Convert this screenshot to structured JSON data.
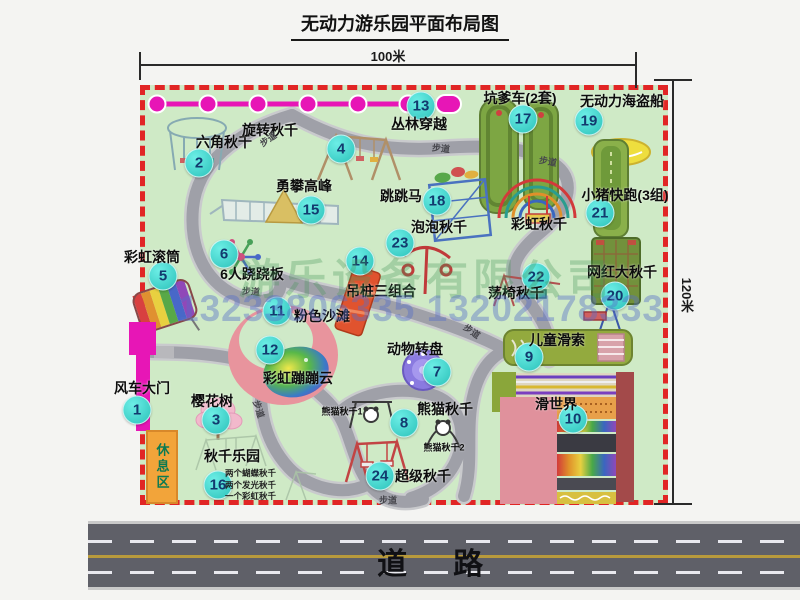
{
  "title": "无动力游乐园平面布局图",
  "dimensions": {
    "top": "100米",
    "right": "120米"
  },
  "road": {
    "label": "道路"
  },
  "rest_area": {
    "label": "休息区"
  },
  "watermark": {
    "line1": "游乐设备有限公司",
    "line2": "13233806335 13202178333"
  },
  "colors": {
    "map_bg": "#cfeac6",
    "border_red": "#e12525",
    "walkway": "#9fa0a8",
    "marker": "#2cc2ba",
    "marker_text": "#123a6e",
    "magenta_track": "#e716b6",
    "road_gray": "#5f6068",
    "rest_orange": "#f2a43a"
  },
  "attractions": [
    {
      "num": "1",
      "name": "风车大门",
      "cx": 137,
      "cy": 410,
      "lx": 142,
      "ly": 388
    },
    {
      "num": "2",
      "name": "六角秋千",
      "cx": 199,
      "cy": 163,
      "lx": 224,
      "ly": 142
    },
    {
      "num": "3",
      "name": "樱花树",
      "cx": 216,
      "cy": 420,
      "lx": 212,
      "ly": 401
    },
    {
      "num": "4",
      "name": "旋转秋千",
      "cx": 341,
      "cy": 149,
      "lx": 270,
      "ly": 130
    },
    {
      "num": "5",
      "name": "彩虹滚筒",
      "cx": 163,
      "cy": 276,
      "lx": 152,
      "ly": 257
    },
    {
      "num": "6",
      "name": "6人跷跷板",
      "cx": 224,
      "cy": 254,
      "lx": 252,
      "ly": 274
    },
    {
      "num": "7",
      "name": "动物转盘",
      "cx": 437,
      "cy": 372,
      "lx": 415,
      "ly": 349
    },
    {
      "num": "8",
      "name": "熊猫秋千",
      "cx": 404,
      "cy": 423,
      "lx": 445,
      "ly": 409
    },
    {
      "num": "9",
      "name": "儿童滑索",
      "cx": 529,
      "cy": 357,
      "lx": 557,
      "ly": 340
    },
    {
      "num": "10",
      "name": "滑世界",
      "cx": 573,
      "cy": 419,
      "lx": 556,
      "ly": 404
    },
    {
      "num": "11",
      "name": "粉色沙滩",
      "cx": 277,
      "cy": 311,
      "lx": 322,
      "ly": 316
    },
    {
      "num": "12",
      "name": "彩虹蹦蹦云",
      "cx": 270,
      "cy": 350,
      "lx": 298,
      "ly": 378
    },
    {
      "num": "13",
      "name": "丛林穿越",
      "cx": 421,
      "cy": 106,
      "lx": 419,
      "ly": 124
    },
    {
      "num": "14",
      "name": "吊桩三组合",
      "cx": 360,
      "cy": 261,
      "lx": 381,
      "ly": 291
    },
    {
      "num": "15",
      "name": "勇攀高峰",
      "cx": 311,
      "cy": 210,
      "lx": 304,
      "ly": 186
    },
    {
      "num": "16",
      "name": "秋千乐园",
      "cx": 218,
      "cy": 485,
      "lx": 232,
      "ly": 456
    },
    {
      "num": "17",
      "name": "坑爹车(2套)",
      "cx": 523,
      "cy": 119,
      "lx": 520,
      "ly": 98
    },
    {
      "num": "18",
      "name": "跳跳马",
      "cx": 437,
      "cy": 201,
      "lx": 401,
      "ly": 196
    },
    {
      "num": "19",
      "name": "无动力海盗船",
      "cx": 589,
      "cy": 121,
      "lx": 622,
      "ly": 101
    },
    {
      "num": "20",
      "name": "网红大秋千",
      "cx": 615,
      "cy": 296,
      "lx": 622,
      "ly": 272
    },
    {
      "num": "21",
      "name": "小猪快跑(3组)",
      "cx": 600,
      "cy": 213,
      "lx": 625,
      "ly": 195
    },
    {
      "num": "22",
      "name": "荡椅秋千",
      "cx": 536,
      "cy": 277,
      "lx": 516,
      "ly": 293
    },
    {
      "num": "23",
      "name": "泡泡秋千",
      "cx": 400,
      "cy": 243,
      "lx": 439,
      "ly": 227
    },
    {
      "num": "24",
      "name": "超级秋千",
      "cx": 380,
      "cy": 476,
      "lx": 423,
      "ly": 476
    }
  ],
  "extra_labels": [
    {
      "text": "彩虹秋千",
      "x": 539,
      "y": 224,
      "size": 14
    },
    {
      "text": "熊猫秋千1",
      "x": 342,
      "y": 411,
      "size": 9
    },
    {
      "text": "熊猫秋千2",
      "x": 444,
      "y": 447,
      "size": 9
    }
  ],
  "walkway_labels": [
    {
      "text": "步道",
      "x": 268,
      "y": 139,
      "rot": -35
    },
    {
      "text": "步道",
      "x": 441,
      "y": 148,
      "rot": 6
    },
    {
      "text": "步道",
      "x": 548,
      "y": 161,
      "rot": 10
    },
    {
      "text": "步道",
      "x": 251,
      "y": 291,
      "rot": 4
    },
    {
      "text": "步道",
      "x": 472,
      "y": 331,
      "rot": 35
    },
    {
      "text": "步道",
      "x": 259,
      "y": 409,
      "rot": 72
    },
    {
      "text": "步道",
      "x": 388,
      "y": 500,
      "rot": 0
    }
  ],
  "swing_park_notes": [
    "两个蝴蝶秋千",
    "两个发光秋千",
    "一个彩虹秋千"
  ]
}
